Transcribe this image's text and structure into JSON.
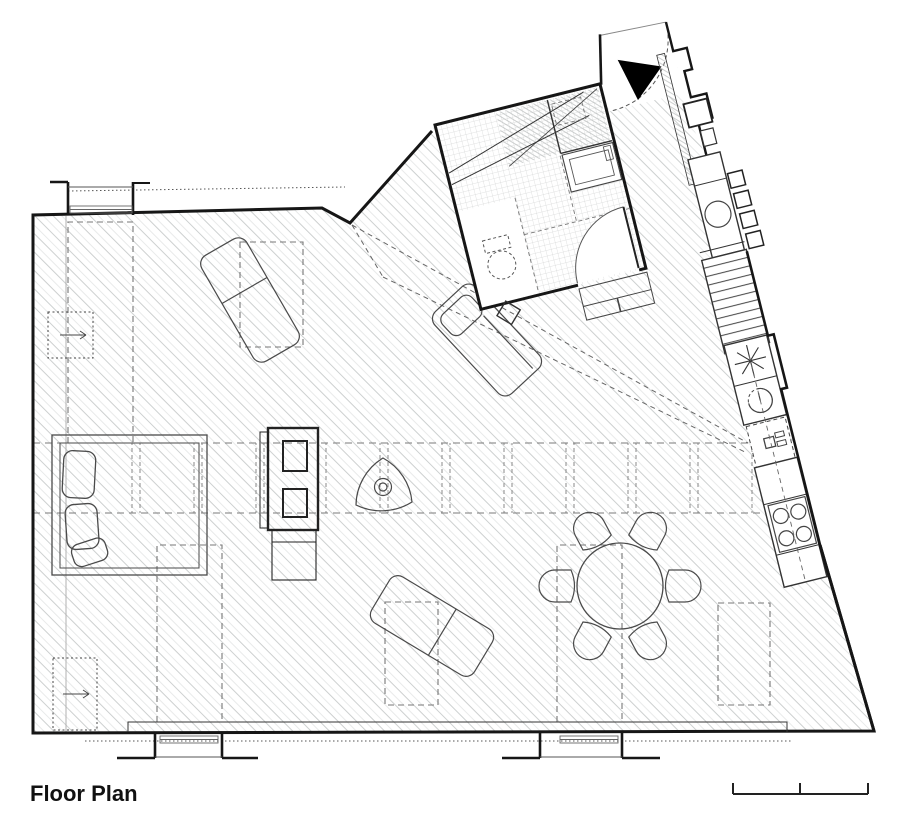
{
  "title": "Floor Plan",
  "drawing": {
    "type": "architectural-floor-plan",
    "rooms": [
      "main-living-area",
      "bathroom",
      "entry-corridor",
      "kitchen-strip"
    ],
    "furniture": [
      "double-bed-with-pillows",
      "wardrobe-shelf-unit",
      "round-side-table",
      "lounger-upper",
      "lounger-middle",
      "lounger-lower",
      "round-dining-table",
      "dining-chairs-x6"
    ],
    "fixtures": [
      "toilet",
      "shower",
      "washbasin",
      "kitchen-sink",
      "extractor-star",
      "boiler",
      "hob-4-burners",
      "ladder-stairs",
      "radiators-x3"
    ],
    "annotations": [
      "entry-direction-arrow",
      "door-swing-arcs",
      "skylight-dashed-outlines",
      "window-projection-lines",
      "beam-band-lines",
      "sight-lines"
    ],
    "colors": {
      "background": "#ffffff",
      "wall": "#161616",
      "furniture": "#4a4a4a",
      "hatch": "#cdd0d0",
      "dashed": "#777777",
      "entry_arrow": "#000000"
    }
  },
  "scale_bar": {
    "ticks": 3
  }
}
